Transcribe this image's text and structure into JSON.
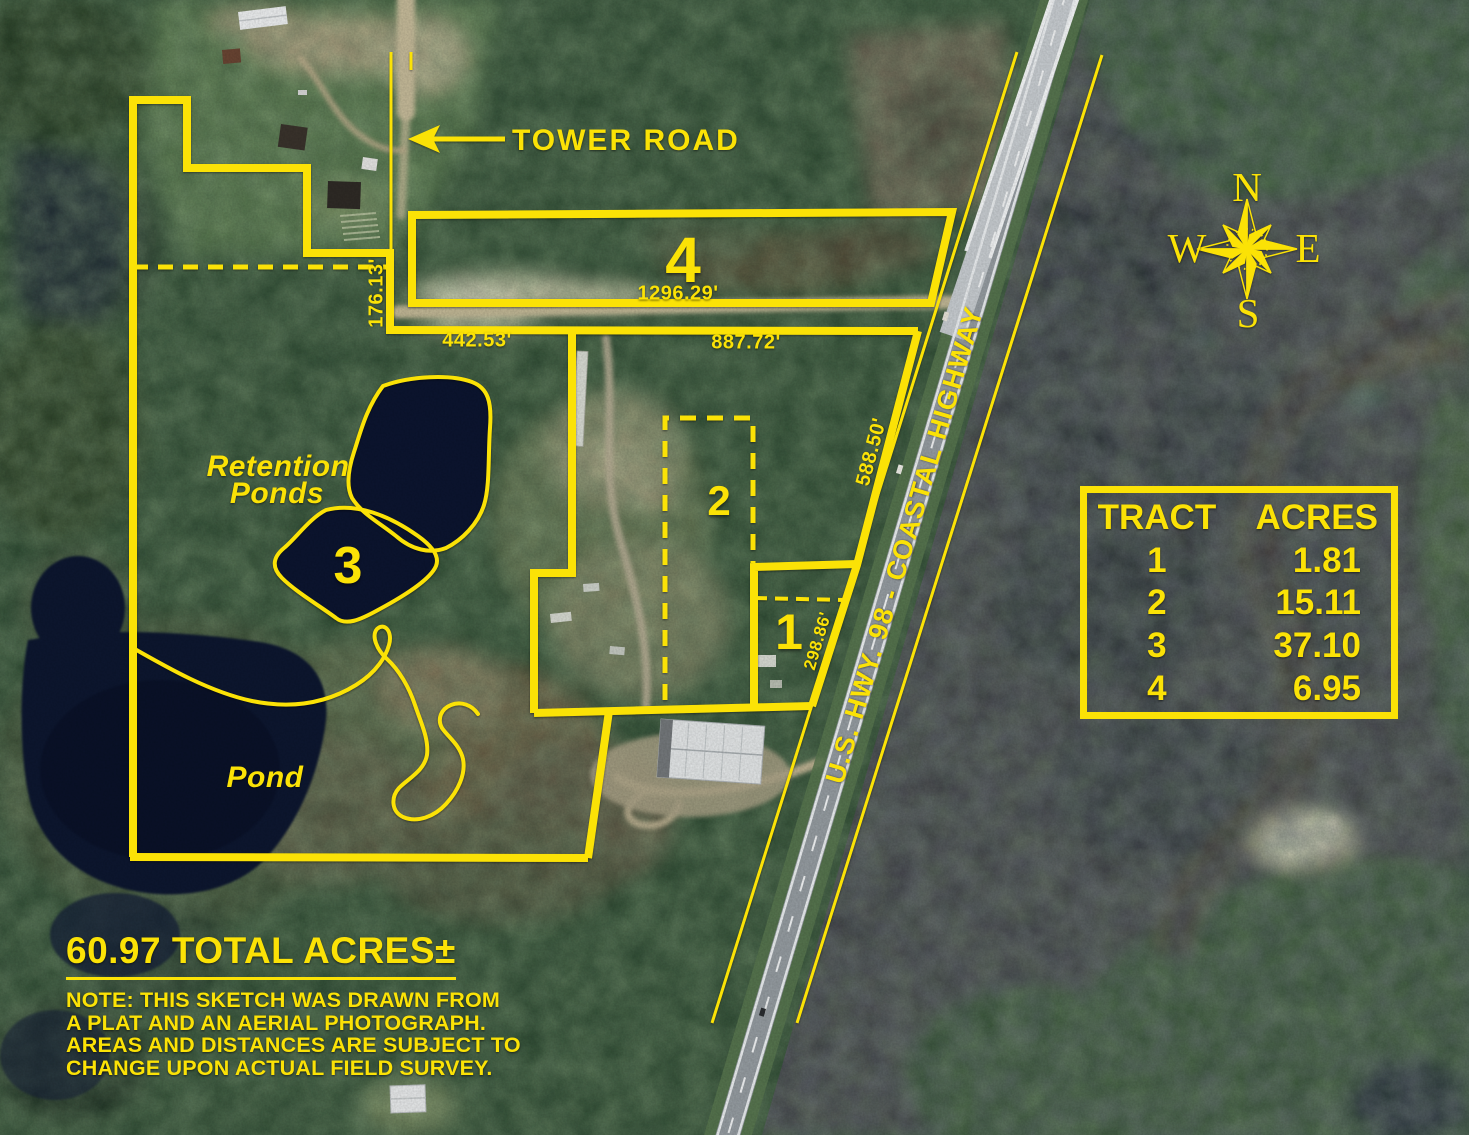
{
  "colors": {
    "annotation_yellow": "#fbe206"
  },
  "road_labels": {
    "tower_road": "TOWER ROAD",
    "highway": "U.S. HWY. 98 - COASTAL HIGHWAY"
  },
  "feature_labels": {
    "retention_ponds_line1": "Retention",
    "retention_ponds_line2": "Ponds",
    "pond": "Pond"
  },
  "tract_numbers": {
    "t1": "1",
    "t2": "2",
    "t3": "3",
    "t4": "4"
  },
  "measurements": {
    "tower_road_frontage": "176.13'",
    "tract2_north_west": "442.53'",
    "tract2_north_east": "887.72'",
    "tract4_south": "1296.29'",
    "tract2_highway_frontage": "588.50'",
    "tract1_highway_frontage": "298.86'"
  },
  "compass": {
    "north": "N",
    "south": "S",
    "east": "E",
    "west": "W"
  },
  "acreage_table": {
    "headers": [
      "TRACT",
      "ACRES"
    ],
    "rows": [
      [
        "1",
        "1.81"
      ],
      [
        "2",
        "15.11"
      ],
      [
        "3",
        "37.10"
      ],
      [
        "4",
        "6.95"
      ]
    ]
  },
  "summary": {
    "total_acres": "60.97 TOTAL ACRES±",
    "note_lines": [
      "NOTE: THIS SKETCH WAS DRAWN FROM",
      "A PLAT AND AN AERIAL PHOTOGRAPH.",
      "AREAS AND DISTANCES ARE SUBJECT TO",
      "CHANGE UPON ACTUAL FIELD SURVEY."
    ]
  }
}
